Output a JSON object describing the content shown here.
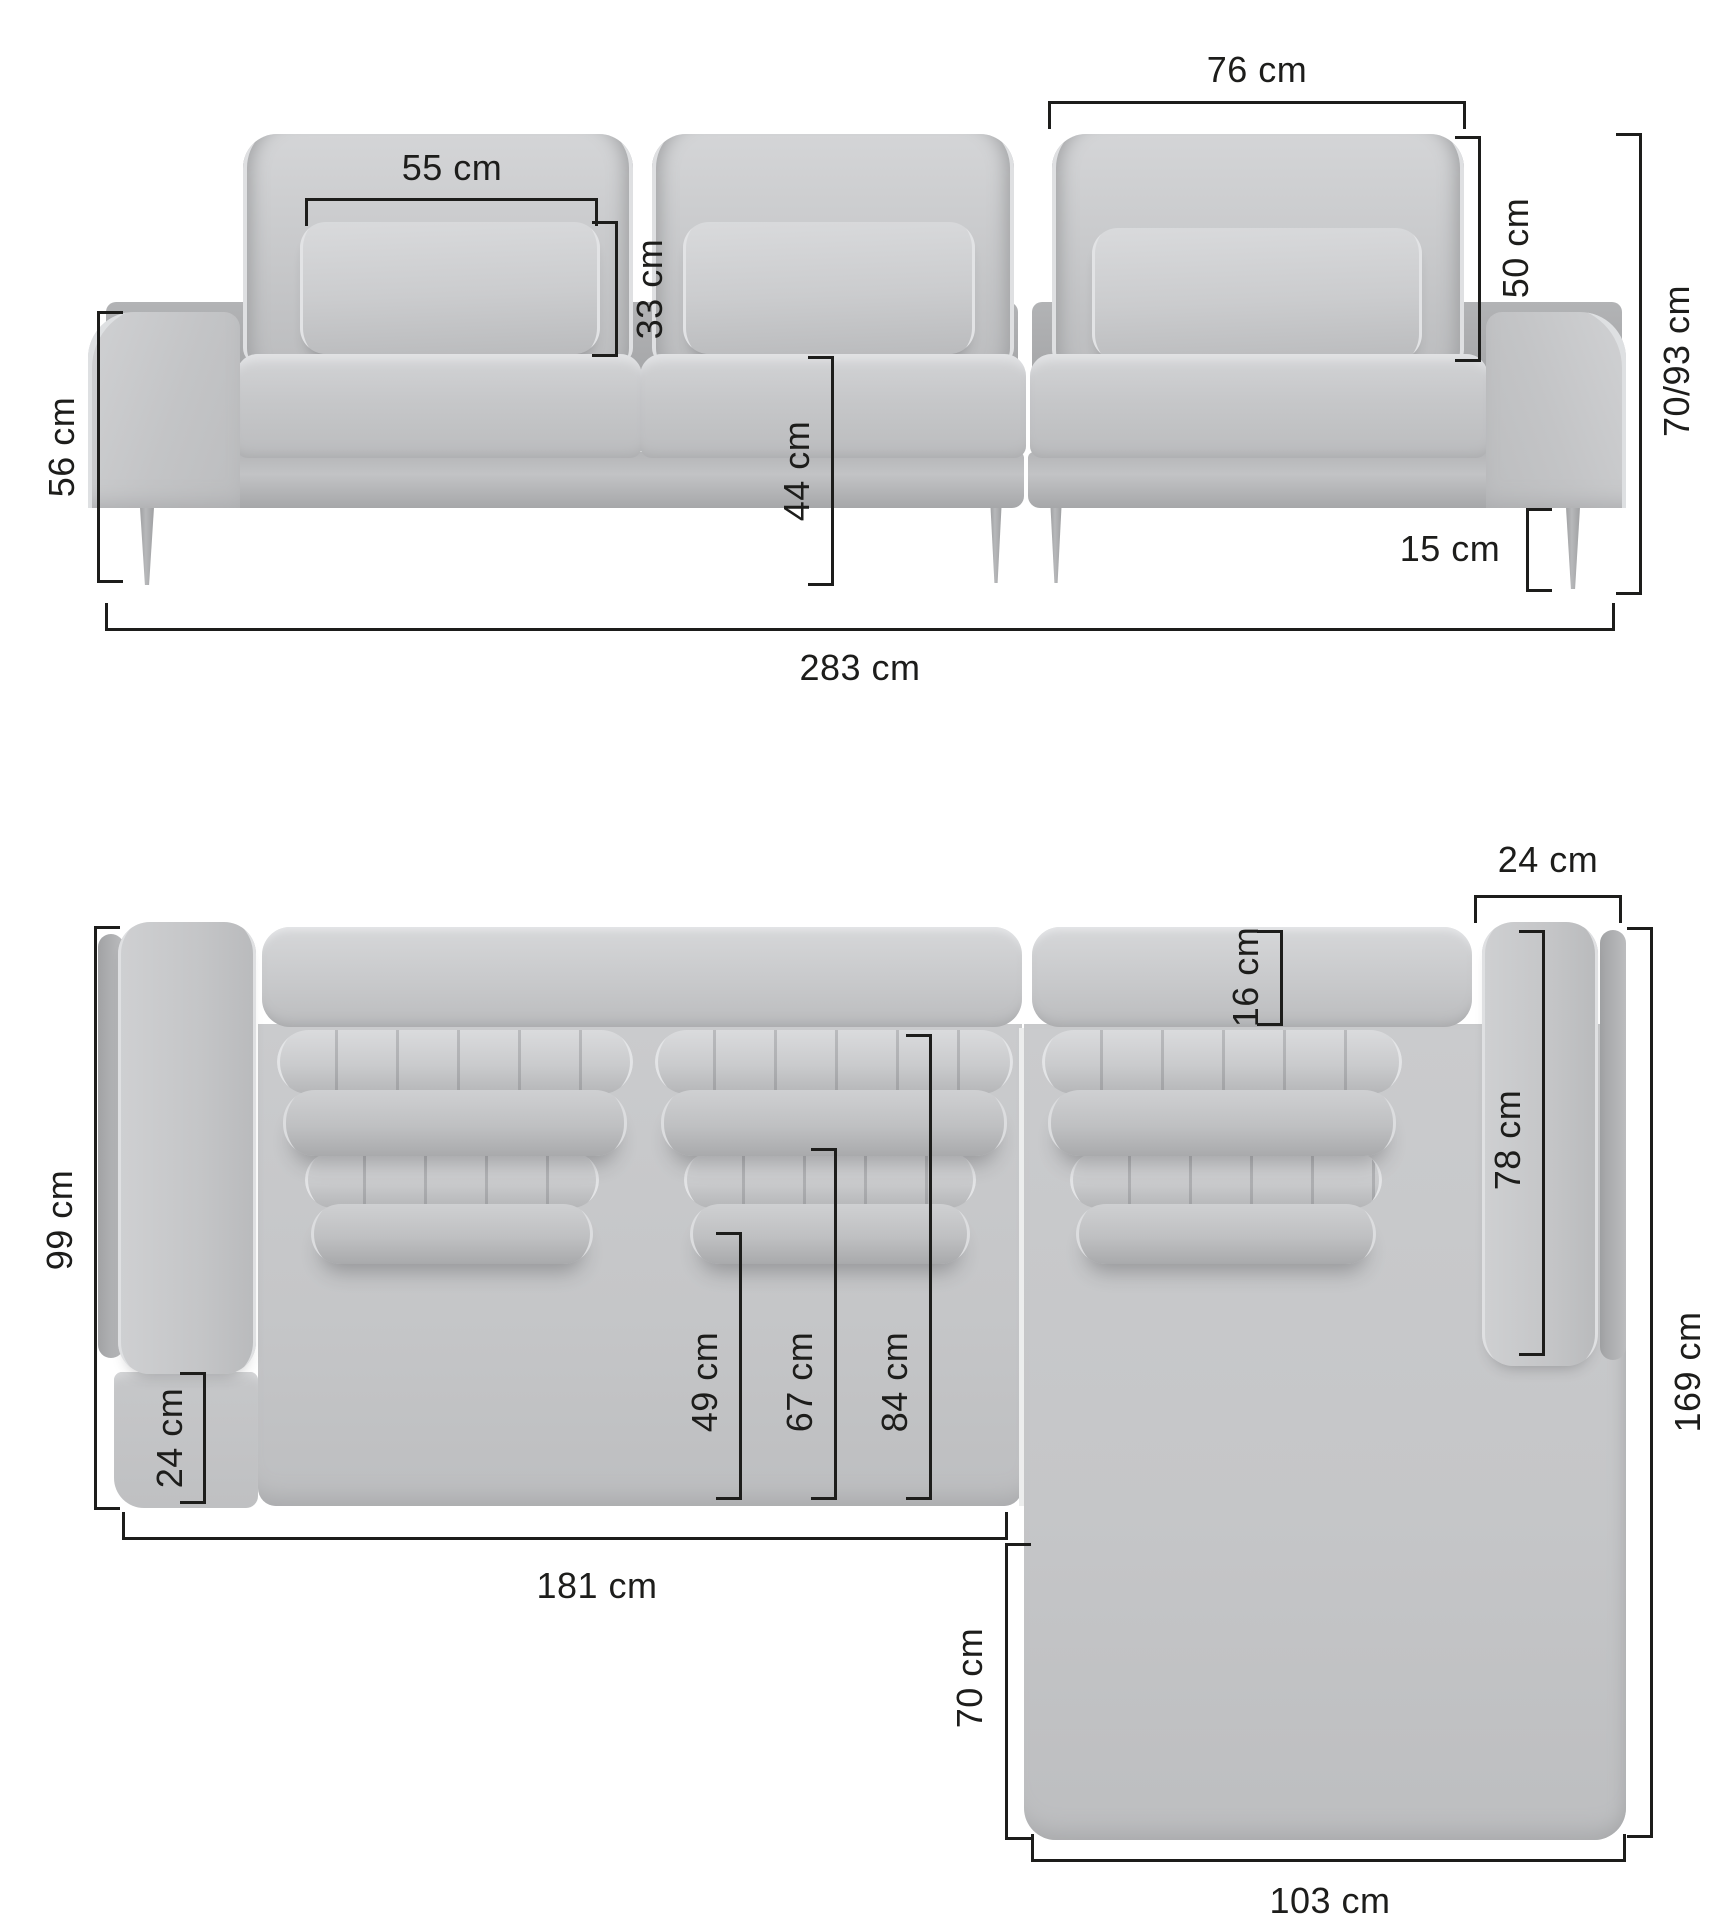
{
  "unit": "cm",
  "colors": {
    "background": "#ffffff",
    "line": "#1d1d1b",
    "sofa_light": "#d6d7d9",
    "sofa_mid": "#c7c8ca",
    "sofa_dark": "#a8a9ab"
  },
  "dims": {
    "front_backrest_width": {
      "label": "76 cm"
    },
    "front_pillow_width": {
      "label": "55 cm"
    },
    "front_pillow_height": {
      "label": "33 cm"
    },
    "front_backrest_height": {
      "label": "50 cm"
    },
    "front_arm_height": {
      "label": "56 cm"
    },
    "front_seat_height": {
      "label": "44 cm"
    },
    "front_total_height": {
      "label": "70/93 cm"
    },
    "front_leg_height": {
      "label": "15 cm"
    },
    "front_total_width": {
      "label": "283 cm"
    },
    "plan_arm_width": {
      "label": "24 cm"
    },
    "plan_back_depth": {
      "label": "16 cm"
    },
    "plan_armrest_length": {
      "label": "78 cm"
    },
    "plan_total_depth": {
      "label": "169 cm"
    },
    "plan_left_depth": {
      "label": "99 cm"
    },
    "plan_front_corner": {
      "label": "24 cm"
    },
    "plan_seat_depth_1": {
      "label": "49 cm"
    },
    "plan_seat_depth_2": {
      "label": "67 cm"
    },
    "plan_seat_depth_3": {
      "label": "84 cm"
    },
    "plan_left_width": {
      "label": "181 cm"
    },
    "plan_chaise_inner": {
      "label": "70 cm"
    },
    "plan_chaise_width": {
      "label": "103 cm"
    }
  }
}
